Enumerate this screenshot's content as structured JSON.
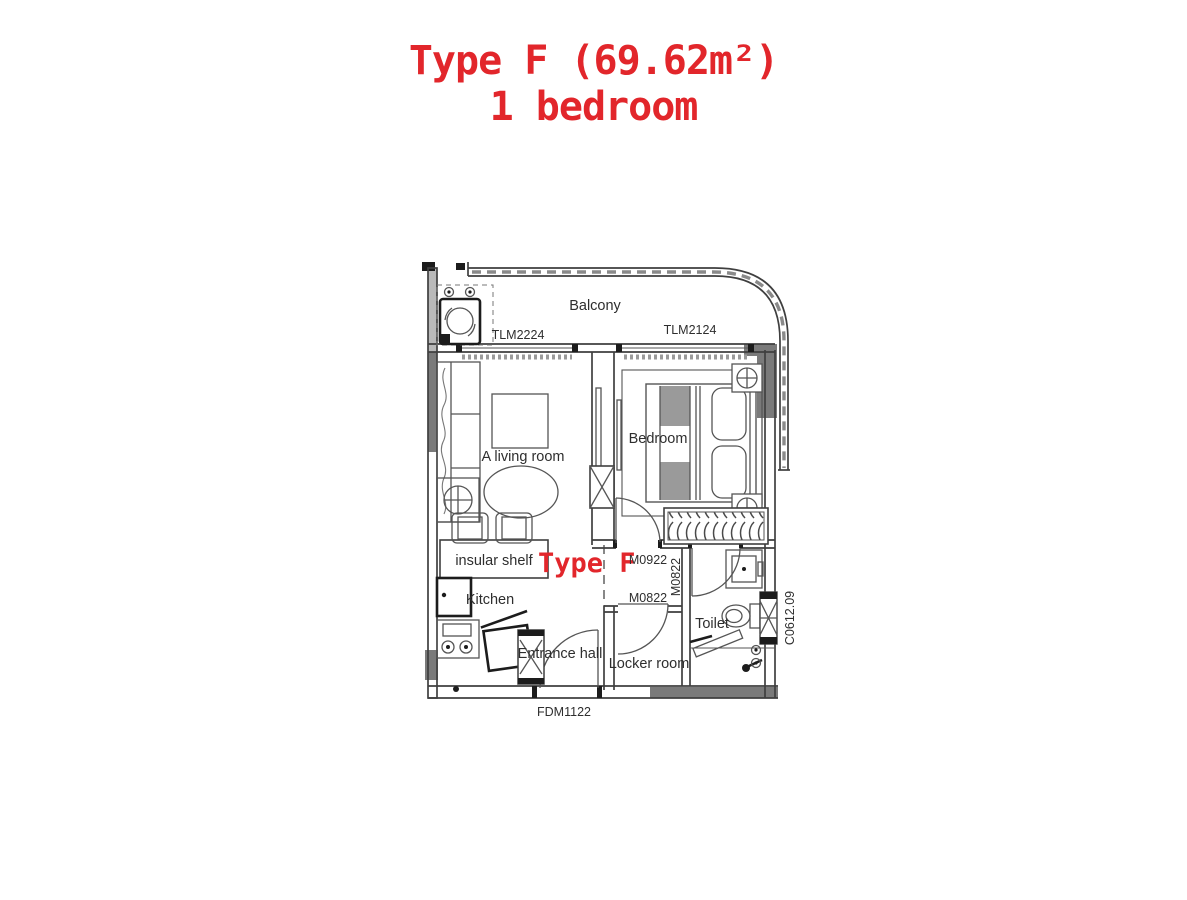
{
  "title": {
    "line1": "Type F (69.62m²)",
    "line2": "1 bedroom"
  },
  "plan": {
    "rooms": {
      "balcony": "Balcony",
      "living_room": "A living room",
      "bedroom": "Bedroom",
      "kitchen": "Kitchen",
      "insular_shelf": "insular shelf",
      "entrance_hall": "Entrance hall",
      "locker_room": "Locker room",
      "toilet": "Toilet"
    },
    "type_label": "Type F",
    "codes": {
      "tlm_left": "TLM2224",
      "tlm_right": "TLM2124",
      "m0922": "M0922",
      "m0822": "M0822",
      "m0822_vertical": "M0822",
      "fdm": "FDM1122",
      "c0612": "C0612.09"
    }
  },
  "colors": {
    "accent_red": "#e2262b",
    "wall_dark": "#7a7a7a",
    "wall_light": "#b9b9b9",
    "line": "#3f3f3f"
  }
}
